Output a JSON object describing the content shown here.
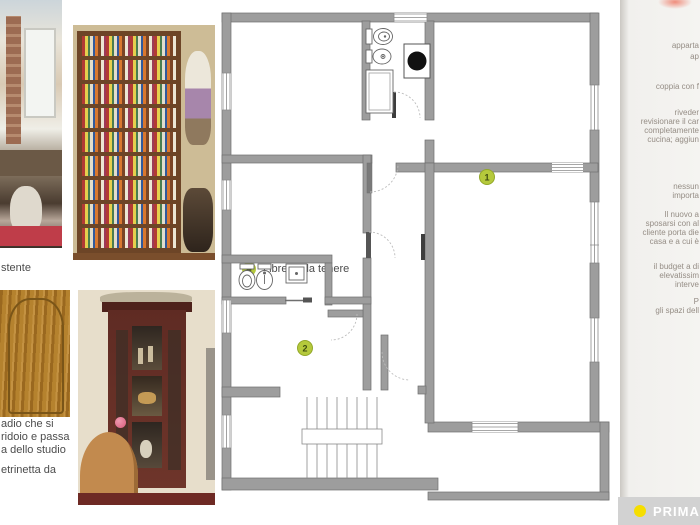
{
  "photo_column": {
    "photo1": {
      "caption_fragment": "stente"
    },
    "photo2": {
      "marker": "4",
      "caption": "Libreria da tenere"
    },
    "photo3": {
      "caption_lines": [
        "adio che si",
        "ridoio e passa",
        "a dello studio"
      ]
    },
    "photo4": {
      "caption_fragment": "etrinetta da"
    }
  },
  "floor_plan": {
    "markers": [
      {
        "label": "1"
      },
      {
        "label": "2"
      }
    ]
  },
  "next_page_edge": {
    "lines": [
      "apparta",
      "ap",
      "coppia con f",
      "riveder",
      "revisionare il car",
      "completamente",
      "cucina; aggiun",
      "nessun",
      "importa",
      "Il nuovo a",
      "sposarsi con al",
      "cliente porta die",
      "casa e a cui è",
      "il budget a di",
      "elevatissim",
      "interve",
      "P",
      "gli spazi dell"
    ]
  },
  "footer": {
    "label": "PRIMA"
  },
  "colors": {
    "marker_green": "#b5c93c",
    "wall_gray": "#9d9d9d",
    "footer_bar": "#d2d2d2",
    "footer_dot": "#f6de00"
  }
}
